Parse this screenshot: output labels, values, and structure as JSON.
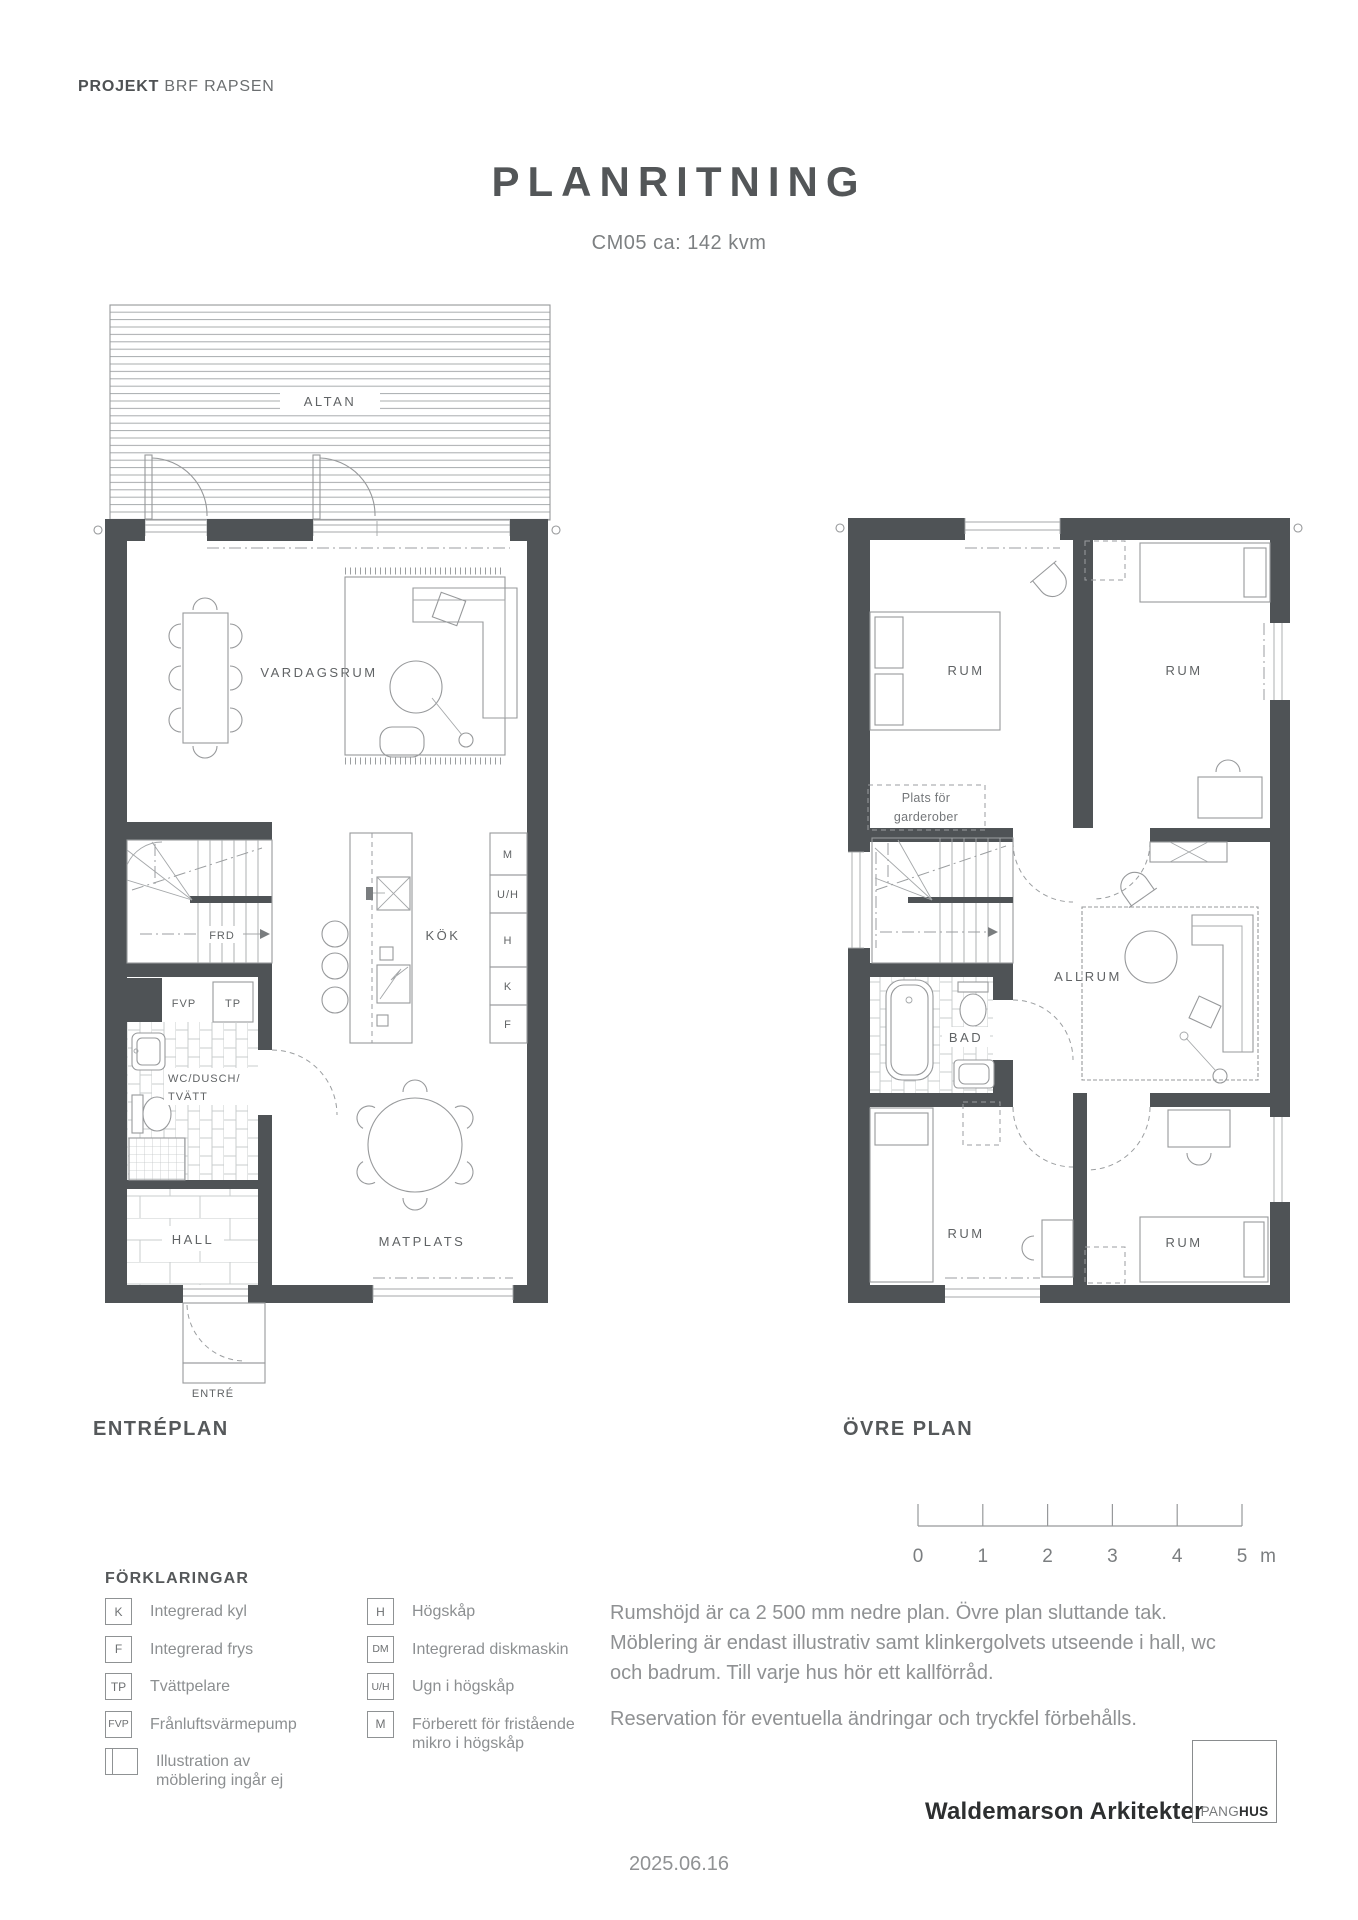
{
  "header": {
    "project_label": "PROJEKT",
    "project_name": "BRF RAPSEN"
  },
  "title": {
    "main": "PLANRITNING",
    "subtitle": "CM05 ca: 142 kvm"
  },
  "floor1": {
    "caption": "ENTRÉPLAN",
    "labels": {
      "altan": "ALTAN",
      "vardagsrum": "VARDAGSRUM",
      "frd": "FRD",
      "fvp": "FVP",
      "tp": "TP",
      "wc_line1": "WC/DUSCH/",
      "wc_line2": "TVÄTT",
      "hall": "HALL",
      "kok": "KÖK",
      "matplats": "MATPLATS",
      "entre": "ENTRÉ"
    },
    "cabinets": [
      "M",
      "U/H",
      "H",
      "K",
      "F"
    ]
  },
  "floor2": {
    "caption": "ÖVRE PLAN",
    "labels": {
      "rum": "RUM",
      "garderob_line1": "Plats för",
      "garderob_line2": "garderober",
      "allrum": "ALLRUM",
      "bad": "BAD"
    }
  },
  "scale_bar": {
    "ticks": [
      "0",
      "1",
      "2",
      "3",
      "4",
      "5"
    ],
    "unit": "m"
  },
  "legend": {
    "heading": "FÖRKLARINGAR",
    "col1": [
      {
        "symbol": "K",
        "label": "Integrerad kyl"
      },
      {
        "symbol": "F",
        "label": "Integrerad frys"
      },
      {
        "symbol": "TP",
        "label": "Tvättpelare"
      },
      {
        "symbol": "FVP",
        "label": "Frånluftsvärmepump"
      },
      {
        "symbol": "",
        "label": "Illustration av\nmöblering ingår ej"
      }
    ],
    "col2": [
      {
        "symbol": "H",
        "label": "Högskåp"
      },
      {
        "symbol": "DM",
        "label": "Integrerad diskmaskin"
      },
      {
        "symbol": "U/H",
        "label": "Ugn i högskåp"
      },
      {
        "symbol": "M",
        "label": "Förberett för fristående\nmikro i högskåp"
      }
    ]
  },
  "notes": {
    "p1": "Rumshöjd är ca 2 500 mm nedre plan. Övre plan sluttande tak.\nMöblering är endast illustrativ samt klinkergolvets utseende i hall, wc\noch badrum. Till varje hus hör ett kallförråd.",
    "p2": "Reservation för eventuella ändringar och tryckfel förbehålls."
  },
  "footer": {
    "architect": "Waldemarson Arkitekter",
    "logo_part1": "PANG",
    "logo_part2": "HUS",
    "date": "2025.06.16"
  },
  "colors": {
    "wall": "#4f5356",
    "line": "#97999b",
    "label": "#606365"
  }
}
